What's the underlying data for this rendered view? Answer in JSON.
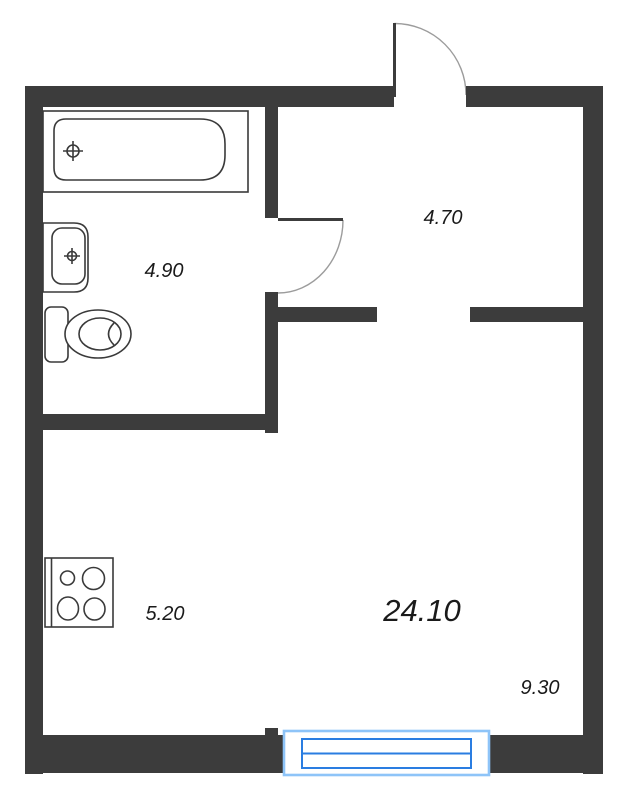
{
  "floorplan": {
    "areas": {
      "bathroom": "4.90",
      "hallway": "4.70",
      "kitchen": "5.20",
      "living_room": "24.10",
      "window_zone": "9.30"
    },
    "fixtures": [
      "bathtub",
      "sink",
      "toilet",
      "stove",
      "window",
      "entrance-door",
      "bathroom-door"
    ],
    "colors": {
      "wall": "#3c3c3c",
      "fixture_line": "#3a3a3a",
      "door_arc": "#9c9c9c",
      "window_frame_light": "#8ec4f8",
      "window_frame_strong": "#2a7de1",
      "label_text": "#1a1a1a",
      "background": "#ffffff"
    }
  }
}
